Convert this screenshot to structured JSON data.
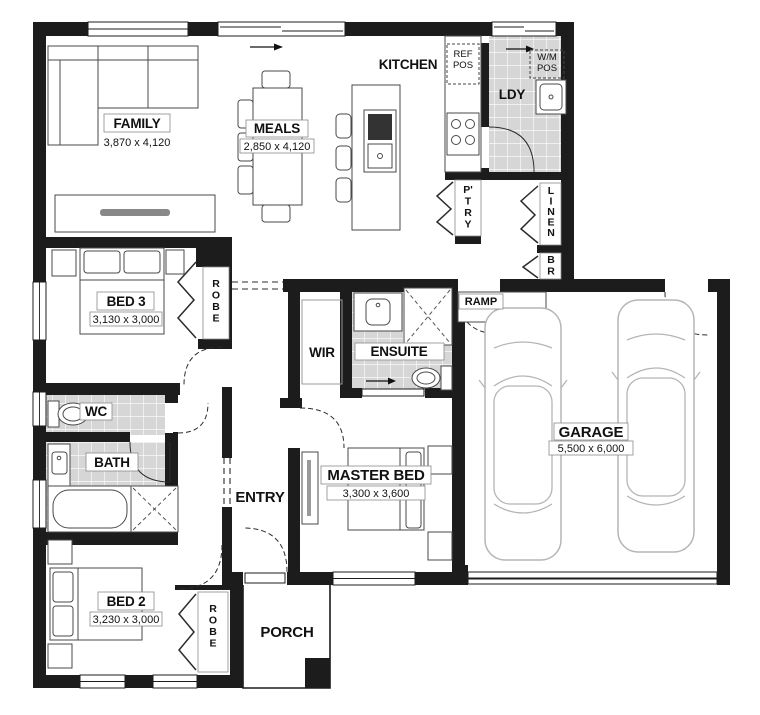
{
  "plan": {
    "rooms": {
      "family": {
        "name": "FAMILY",
        "dims": "3,870 x 4,120"
      },
      "meals": {
        "name": "MEALS",
        "dims": "2,850 x 4,120"
      },
      "kitchen": {
        "name": "KITCHEN"
      },
      "laundry": {
        "name": "LDY"
      },
      "bed3": {
        "name": "BED 3",
        "dims": "3,130 x 3,000"
      },
      "wir": {
        "name": "WIR"
      },
      "ensuite": {
        "name": "ENSUITE"
      },
      "master_bed": {
        "name": "MASTER BED",
        "dims": "3,300 x 3,600"
      },
      "garage": {
        "name": "GARAGE",
        "dims": "5,500 x 6,000"
      },
      "wc": {
        "name": "WC"
      },
      "bath": {
        "name": "BATH"
      },
      "entry": {
        "name": "ENTRY"
      },
      "bed2": {
        "name": "BED 2",
        "dims": "3,230 x 3,000"
      },
      "porch": {
        "name": "PORCH"
      }
    },
    "storage": {
      "pantry": "P'TRY",
      "linen": "LINEN",
      "broom": "BR",
      "robe_bed3": "ROBE",
      "robe_bed2": "ROBE",
      "ramp": "RAMP"
    },
    "appliances": {
      "fridge_line1": "REF",
      "fridge_line2": "POS",
      "washer_line1": "W/M",
      "washer_line2": "POS"
    },
    "colors": {
      "wall": "#1c1c1c",
      "tile_fill": "#d6d6d6",
      "tile_line": "#ffffff",
      "car_outline": "#b5b5b5",
      "furniture_line": "#4a4a4a"
    }
  }
}
